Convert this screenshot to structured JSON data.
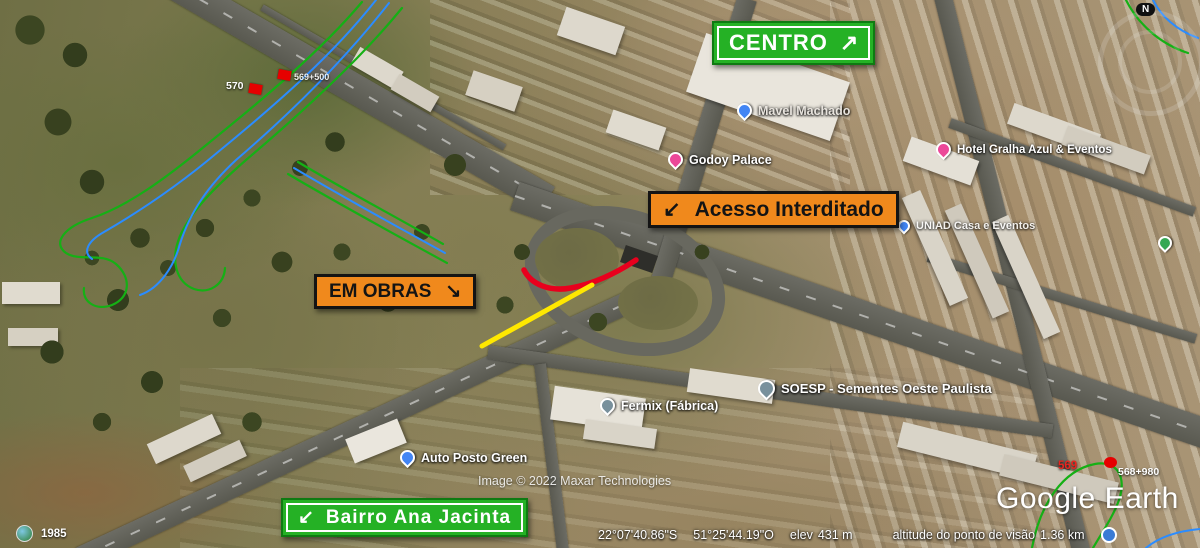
{
  "signs": {
    "centro": {
      "label": "CENTRO",
      "arrow": "↗"
    },
    "acesso_interditado": {
      "label": "Acesso Interditado",
      "arrow": "↙"
    },
    "em_obras": {
      "label": "EM OBRAS",
      "arrow": "↘"
    },
    "bairro_ana_jacinta": {
      "label": "Bairro Ana Jacinta",
      "arrow": "↙"
    }
  },
  "map_labels": [
    {
      "text": "Mavel Machado",
      "pin": "blue"
    },
    {
      "text": "Godoy Palace",
      "pin": "pink"
    },
    {
      "text": "Hotel Gralha Azul & Eventos",
      "pin": "pink"
    },
    {
      "text": "UNIAD Casa e Eventos",
      "pin": "blue"
    },
    {
      "text": "SOESP - Sementes Oeste Paulista",
      "pin": "slate"
    },
    {
      "text": "Fermix (Fábrica)",
      "pin": "slate"
    },
    {
      "text": "Auto Posto Green",
      "pin": "blue"
    }
  ],
  "km_markers": {
    "upper_left_label": "570",
    "upper_right_label": "569+500",
    "right_km": "569",
    "right_station": "568+980"
  },
  "timeline": {
    "year": "1985"
  },
  "watermark": {
    "text": "Google Earth"
  },
  "attribution": {
    "text": "Image © 2022 Maxar Technologies"
  },
  "status_bar": {
    "latitude": "22°07'40.86\"S",
    "longitude": "51°25'44.19\"O",
    "elev_label": "elev",
    "elev_value": "431 m",
    "view_alt_label": "altitude do ponto de visão",
    "view_alt_value": "1.36 km"
  },
  "compass": {
    "north": "N"
  },
  "colors": {
    "sign_green": "#25b125",
    "sign_orange": "#f0891c",
    "overlay_red": "#e8001d",
    "overlay_yellow": "#ffe800",
    "overlay_green": "#15b015",
    "overlay_blue": "#2b8cff"
  }
}
